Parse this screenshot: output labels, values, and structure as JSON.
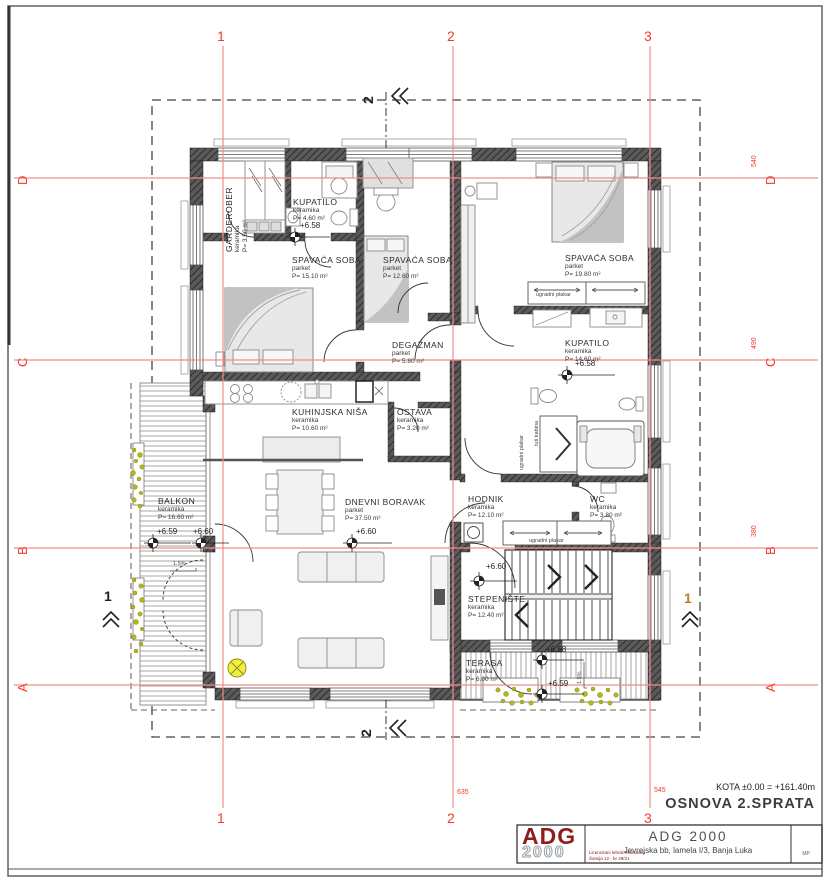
{
  "drawing": {
    "kota_note": "KOTA ±0.00 = +161.40m",
    "title": "OSNOVA 2.SPRATA"
  },
  "axes": {
    "v1": "1",
    "v2": "2",
    "v3": "3",
    "hA": "A",
    "hB": "B",
    "hC": "C",
    "hD": "D",
    "dim_right_D": "540",
    "dim_right_C": "490",
    "dim_right_B": "380",
    "dim_bottom_2": "635",
    "dim_bottom_3": "545"
  },
  "sections": {
    "s1": "1",
    "s2": "2"
  },
  "rooms": [
    {
      "name": "GARDEROBER",
      "finish": "keramika",
      "area": "P= 3.50 m²"
    },
    {
      "name": "KUPATILO",
      "finish": "keramika",
      "area": "P= 4.60 m²",
      "level": "+6.58"
    },
    {
      "name": "SPAVAĆA SOBA",
      "finish": "parket",
      "area": "P= 15.10 m²"
    },
    {
      "name": "SPAVAĆA SOBA",
      "finish": "parket",
      "area": "P= 12.60 m²"
    },
    {
      "name": "SPAVAĆA SOBA",
      "finish": "parket",
      "area": "P= 19.80 m²"
    },
    {
      "name": "DEGAŽMAN",
      "finish": "parket",
      "area": "P= 5.80 m²"
    },
    {
      "name": "KUPATILO",
      "finish": "keramika",
      "area": "P= 14.60 m²",
      "level": "+6.58"
    },
    {
      "name": "KUHINJSKA NIŠA",
      "finish": "keramika",
      "area": "P= 10.60 m²"
    },
    {
      "name": "OSTAVA",
      "finish": "keramika",
      "area": "P= 3.20 m²"
    },
    {
      "name": "DNEVNI BORAVAK",
      "finish": "parket",
      "area": "P= 37.50 m²",
      "level": "+6.60"
    },
    {
      "name": "BALKON",
      "finish": "keramika",
      "area": "P= 16.60 m²",
      "level": "+6.59",
      "level2": "+6.60"
    },
    {
      "name": "HODNIK",
      "finish": "keramika",
      "area": "P= 12.10 m²"
    },
    {
      "name": "WC",
      "finish": "keramika",
      "area": "P= 3.80 m²"
    },
    {
      "name": "STEPENIŠTE",
      "finish": "keramika",
      "area": "P= 12.40 m²",
      "level": "+6.60"
    },
    {
      "name": "TERASA",
      "finish": "keramika",
      "area": "P= 6.00 m²",
      "level": "+6.58",
      "level2": "+6.59"
    }
  ],
  "annotations": {
    "wardrobe": "ugradni plakar",
    "shower": "tuš kabina",
    "slope": "1.5%"
  },
  "title_block": {
    "logo_line1": "ADG",
    "logo_line2": "2000",
    "company": "ADG  2000",
    "address": "Jevrejska bb, lamela I/3,   Banja Luka",
    "note_line1": "Licencirani tehnik Milosavka",
    "note_line2": "Šamija 12 - br 29/21",
    "stamp": "MP."
  },
  "colors": {
    "axis_line": "#f08c8c",
    "axis_label": "#f5392c",
    "wall": "#565656",
    "plant": "#b5b61e",
    "logo_red": "#8f1d1d"
  }
}
